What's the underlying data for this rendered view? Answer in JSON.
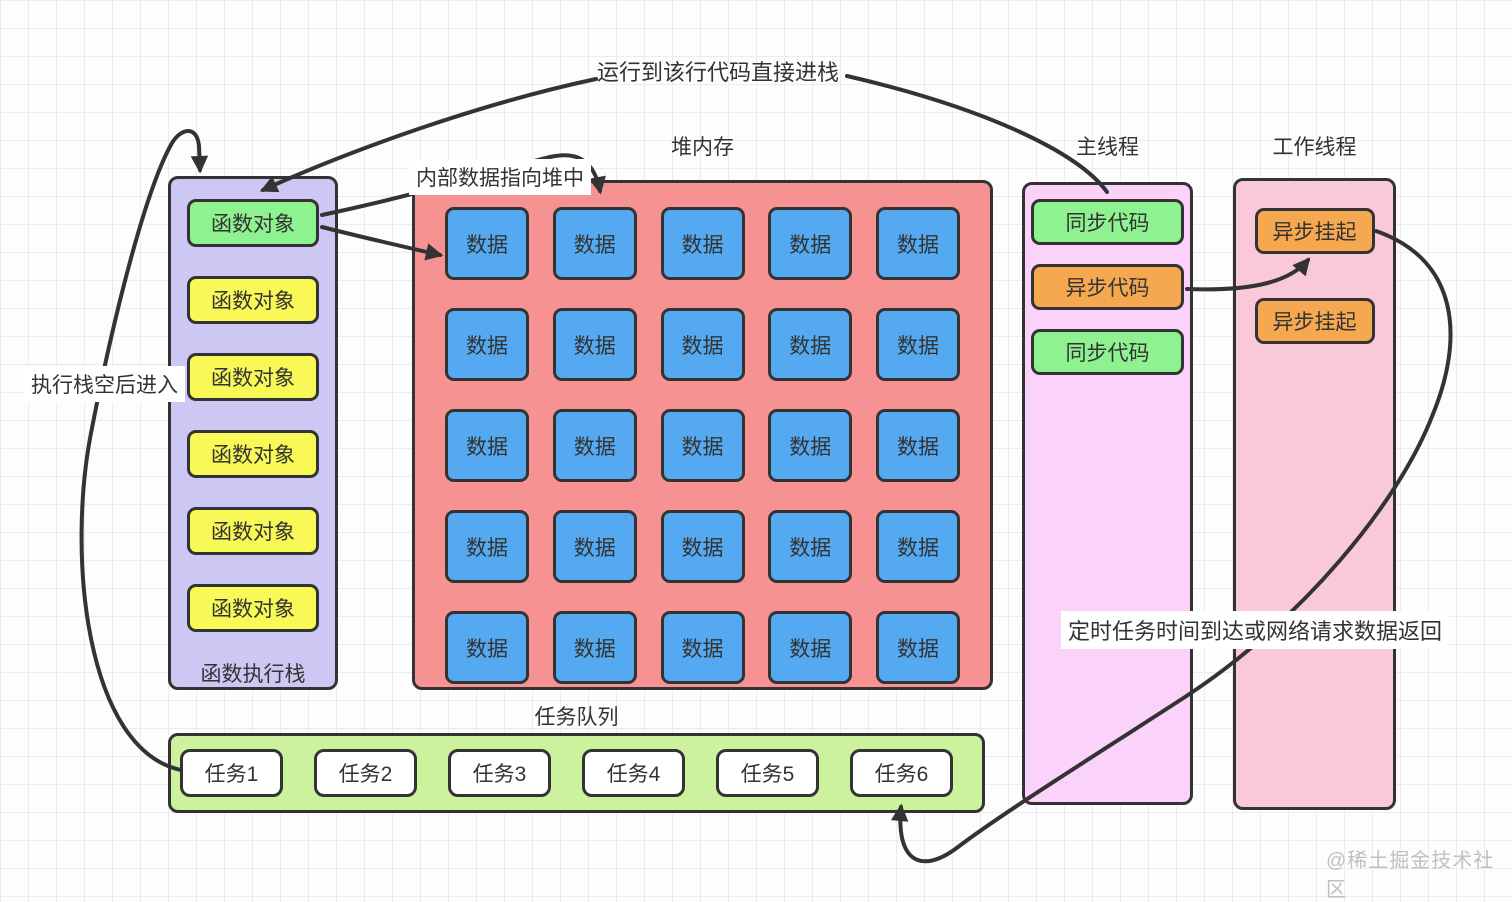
{
  "colors": {
    "green": "#8df28f",
    "yellow": "#f8f857",
    "orange": "#f6a851",
    "blue": "#54a9f1",
    "stack_bg": "#cdc7f3",
    "heap_bg": "#f79292",
    "main_bg": "#fbd2fa",
    "worker_bg": "#f9c9da",
    "queue_bg": "#cdf29e",
    "task_bg": "#ffffff",
    "line": "#333333",
    "text": "#333333",
    "watermark": "#c0c0c0"
  },
  "annotations": {
    "top": "运行到该行代码直接进栈",
    "stack_enter": "执行栈空后进入",
    "heap_pointer": "内部数据指向堆中",
    "timer_return": "定时任务时间到达或网络请求数据返回"
  },
  "stack": {
    "title": "函数执行栈",
    "items": [
      {
        "label": "函数对象",
        "color": "green"
      },
      {
        "label": "函数对象",
        "color": "yellow"
      },
      {
        "label": "函数对象",
        "color": "yellow"
      },
      {
        "label": "函数对象",
        "color": "yellow"
      },
      {
        "label": "函数对象",
        "color": "yellow"
      },
      {
        "label": "函数对象",
        "color": "yellow"
      }
    ]
  },
  "heap": {
    "title": "堆内存",
    "cell_label": "数据",
    "cell_count": 25,
    "rows": 5,
    "cols": 5
  },
  "main_thread": {
    "title": "主线程",
    "blocks": [
      {
        "label": "同步代码",
        "color": "green"
      },
      {
        "label": "异步代码",
        "color": "orange"
      },
      {
        "label": "同步代码",
        "color": "green"
      }
    ]
  },
  "worker_thread": {
    "title": "工作线程",
    "blocks": [
      {
        "label": "异步挂起",
        "color": "orange"
      },
      {
        "label": "异步挂起",
        "color": "orange"
      }
    ]
  },
  "task_queue": {
    "title": "任务队列",
    "tasks": [
      {
        "label": "任务1",
        "color": "white"
      },
      {
        "label": "任务2",
        "color": "white"
      },
      {
        "label": "任务3",
        "color": "white"
      },
      {
        "label": "任务4",
        "color": "white"
      },
      {
        "label": "任务5",
        "color": "white"
      },
      {
        "label": "任务6",
        "color": "white"
      }
    ]
  },
  "watermark": "@稀土掘金技术社区"
}
